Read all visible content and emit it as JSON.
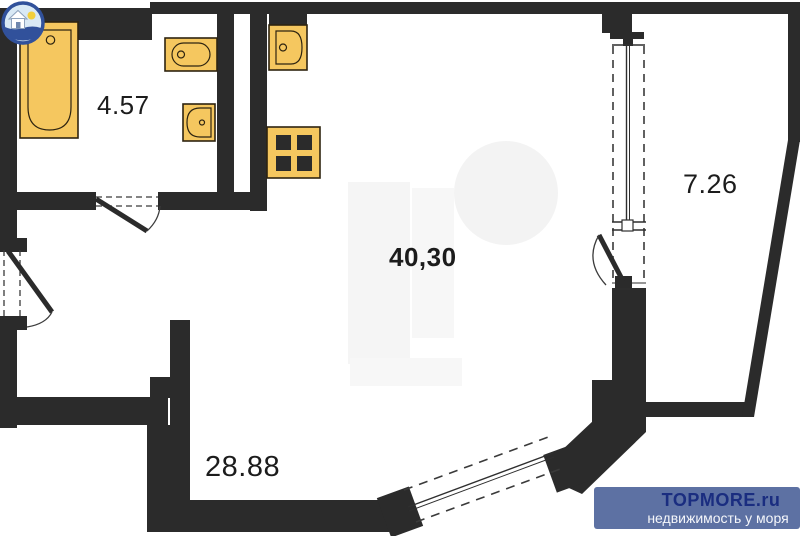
{
  "floorplan": {
    "rooms": [
      {
        "name": "bathroom",
        "area_label": "4.57"
      },
      {
        "name": "living-room",
        "area_label": "40,30"
      },
      {
        "name": "balcony",
        "area_label": "7.26"
      },
      {
        "name": "hall",
        "area_label": "28.88"
      }
    ],
    "fixtures": [
      {
        "name": "bathtub-icon"
      },
      {
        "name": "sink-icon"
      },
      {
        "name": "toilet-icon"
      },
      {
        "name": "kitchen-sink-icon"
      },
      {
        "name": "stove-icon"
      }
    ],
    "colors": {
      "wall": "#2b2b2b",
      "fixture_fill": "#f5c75f",
      "fixture_stroke": "#2e2410",
      "background": "#ffffff"
    }
  },
  "watermark": {
    "brand": "TOPMORE.ru",
    "tagline": "недвижимость у моря",
    "colors": {
      "banner": "#5d71a3",
      "brand_text": "#1a2d80",
      "tagline_text": "#f4f6fa"
    }
  }
}
